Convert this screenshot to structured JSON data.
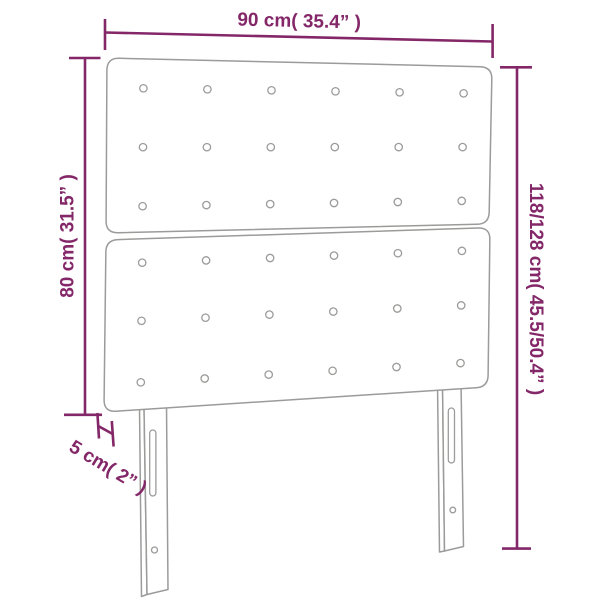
{
  "diagram": {
    "type": "furniture-dimension-diagram",
    "product": "tufted headboard with two panels and two mounting legs",
    "colors": {
      "dimension_annotation": "#832768",
      "product_outline": "#9B9B9A",
      "background": "#FFFFFF"
    },
    "dimensions": {
      "width": {
        "label": "90 cm( 35.4” )",
        "cm": 90,
        "inch": 35.4
      },
      "headboard_height": {
        "label": "80 cm( 31.5” )",
        "cm": 80,
        "inch": 31.5
      },
      "total_height": {
        "label": "118/128 cm( 45.5/50.4” )",
        "cm": "118/128",
        "inch": "45.5/50.4"
      },
      "thickness": {
        "label": "5 cm( 2” )",
        "cm": 5,
        "inch": 2
      }
    },
    "headboard": {
      "panel_count": 2,
      "button_columns": 6,
      "button_rows_per_panel": 3,
      "leg_count": 2
    }
  }
}
